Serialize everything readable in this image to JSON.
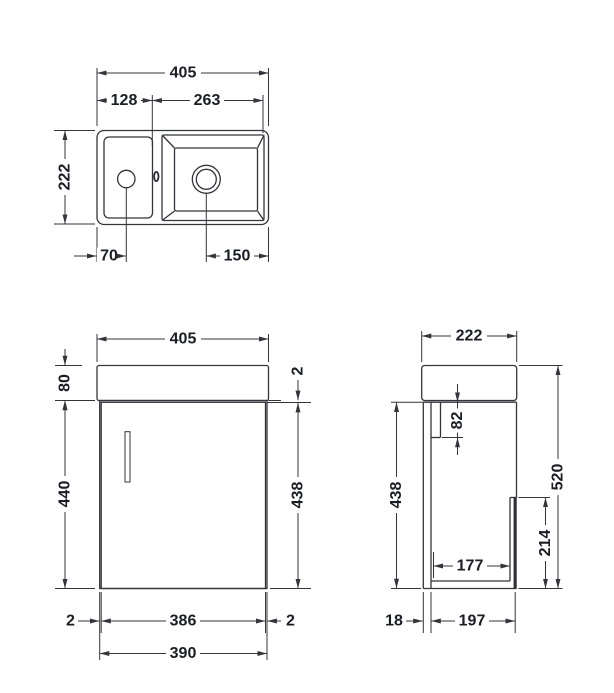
{
  "views": {
    "top": {
      "name": "basin plan view",
      "dims": {
        "width": "405",
        "deck_width": "128",
        "bowl_width": "263",
        "depth": "222",
        "tap_offset": "70",
        "waste_offset": "150"
      }
    },
    "front": {
      "name": "front elevation",
      "dims": {
        "width": "405",
        "basin_height": "80",
        "top_gap": "2",
        "cabinet_height": "440",
        "door_height": "438",
        "left_gap": "2",
        "door_width": "386",
        "right_gap": "2",
        "cabinet_width": "390"
      }
    },
    "side": {
      "name": "side elevation",
      "dims": {
        "depth": "222",
        "rail_height": "82",
        "door_height": "438",
        "total_height": "520",
        "back_panel_height": "214",
        "internal_depth": "177",
        "door_thickness": "18",
        "carcass_depth": "197"
      }
    }
  }
}
